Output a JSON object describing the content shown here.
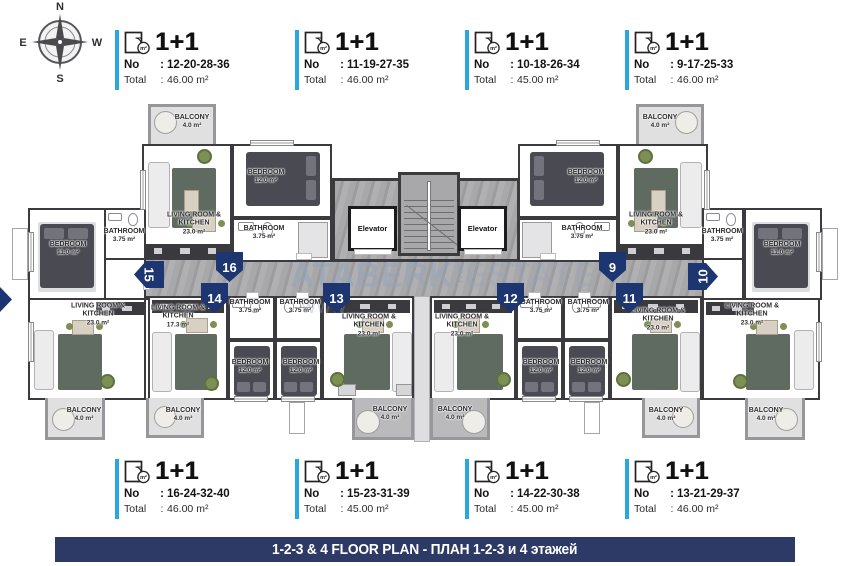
{
  "compass": {
    "north": "N",
    "south": "S",
    "east": "E",
    "west": "W"
  },
  "labels": {
    "no": "No",
    "total": "Total",
    "colon": ":",
    "unit_type": "1+1",
    "icon_badge": "m²"
  },
  "cards": {
    "top": [
      {
        "no": "12-20-28-36",
        "total": "46.00 m²"
      },
      {
        "no": "11-19-27-35",
        "total": "46.00 m²"
      },
      {
        "no": "10-18-26-34",
        "total": "45.00 m²"
      },
      {
        "no": "9-17-25-33",
        "total": "46.00 m²"
      }
    ],
    "bottom": [
      {
        "no": "16-24-32-40",
        "total": "46.00 m²"
      },
      {
        "no": "15-23-31-39",
        "total": "45.00 m²"
      },
      {
        "no": "14-22-30-38",
        "total": "45.00 m²"
      },
      {
        "no": "13-21-29-37",
        "total": "46.00 m²"
      }
    ]
  },
  "rooms": {
    "living1": "LIVING ROOM &",
    "living2": "KITCHEN",
    "bedroom": "BEDROOM",
    "bathroom": "BATHROOM",
    "balcony": "BALCONY",
    "area23": "23.0 m²",
    "area17": "17.3 m²",
    "area12": "12.0 m²",
    "area11": "11.0 m²",
    "areaBath": "3.75 m²",
    "areaBalc": "4.0 m²"
  },
  "elevator_label": "Elevator",
  "markers": {
    "m9": "9",
    "m10": "10",
    "m11": "11",
    "m12": "12",
    "m13": "13",
    "m14": "14",
    "m15": "15",
    "m16": "16"
  },
  "watermark": {
    "left": "ATABERK",
    "vertical": "REAL",
    "right": "ESTATE",
    "fragment": "WWW"
  },
  "banner": "1-2-3 & 4 FLOOR PLAN - ПЛАН 1-2-3 и 4 этажей",
  "colors": {
    "accent": "#29a8e0",
    "banner_navy": "#2e3a66",
    "marker_navy": "#1d3570",
    "wall": "#3b3b3f"
  }
}
